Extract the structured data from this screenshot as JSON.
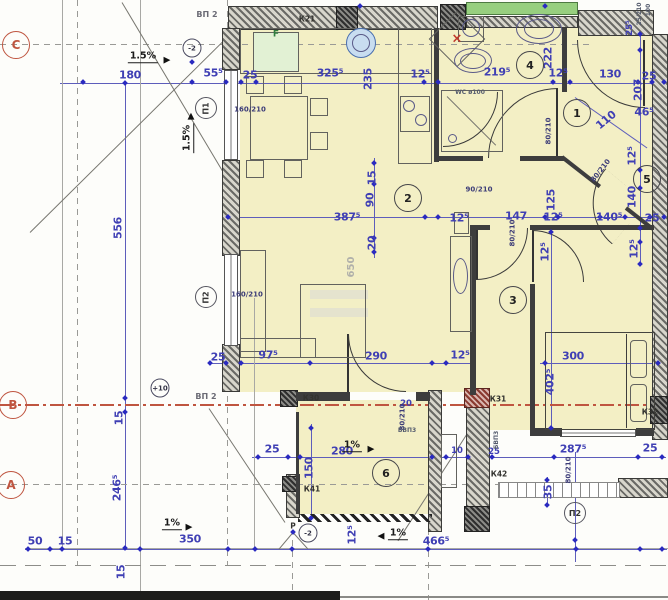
{
  "title": "Apartment floor plan sheet",
  "colors": {
    "blue": "#3f3fb4",
    "red": "#bf5540",
    "yellow": "#f3efc5",
    "green": "#97cf7f",
    "wall": "#3d3d3d"
  },
  "annotations": [
    {
      "t": "ВП 2",
      "x": 207,
      "y": 15,
      "c": "gray"
    },
    {
      "t": "1.5%",
      "x": 143,
      "y": 57,
      "c": "slope"
    },
    {
      "t": "▶",
      "x": 167,
      "y": 61,
      "c": "arrow"
    },
    {
      "t": "180",
      "x": 130,
      "y": 75,
      "c": "d"
    },
    {
      "t": "55⁵",
      "x": 213,
      "y": 73,
      "c": "d"
    },
    {
      "t": "25",
      "x": 250,
      "y": 75,
      "c": "d"
    },
    {
      "t": "325⁵",
      "x": 330,
      "y": 73,
      "c": "d"
    },
    {
      "t": "12⁵",
      "x": 420,
      "y": 74,
      "c": "d"
    },
    {
      "t": "219⁵",
      "x": 497,
      "y": 72,
      "c": "d"
    },
    {
      "t": "12⁵",
      "x": 558,
      "y": 73,
      "c": "d"
    },
    {
      "t": "130",
      "x": 610,
      "y": 74,
      "c": "d"
    },
    {
      "t": "25",
      "x": 649,
      "y": 76,
      "c": "d"
    },
    {
      "t": "К21",
      "x": 307,
      "y": 19,
      "c": "k"
    },
    {
      "t": "F",
      "x": 276,
      "y": 35,
      "c": "greent"
    },
    {
      "t": "235",
      "x": 368,
      "y": 79,
      "r": -90,
      "c": "d"
    },
    {
      "t": "222",
      "x": 548,
      "y": 58,
      "r": -90,
      "c": "d"
    },
    {
      "t": "100",
      "x": 649,
      "y": 10,
      "r": -90,
      "c": "tiny"
    },
    {
      "t": "25/210",
      "x": 640,
      "y": 14,
      "r": -90,
      "c": "tiny"
    },
    {
      "t": "25⁵",
      "x": 630,
      "y": 28,
      "r": -90,
      "c": "ds"
    },
    {
      "t": "207",
      "x": 638,
      "y": 90,
      "r": -90,
      "c": "d"
    },
    {
      "t": "46⁵",
      "x": 644,
      "y": 112,
      "c": "d"
    },
    {
      "t": "110",
      "x": 606,
      "y": 120,
      "r": -40,
      "c": "d"
    },
    {
      "t": "80/210",
      "x": 549,
      "y": 131,
      "r": -90,
      "c": "door"
    },
    {
      "t": "12⁵",
      "x": 632,
      "y": 156,
      "r": -90,
      "c": "d"
    },
    {
      "t": "80/210",
      "x": 601,
      "y": 171,
      "r": -52,
      "c": "door"
    },
    {
      "t": "140",
      "x": 632,
      "y": 197,
      "r": -90,
      "c": "d"
    },
    {
      "t": "140⁵",
      "x": 609,
      "y": 217,
      "c": "d"
    },
    {
      "t": "25",
      "x": 652,
      "y": 218,
      "c": "d"
    },
    {
      "t": "12⁵",
      "x": 634,
      "y": 249,
      "r": -90,
      "c": "d"
    },
    {
      "t": "1.5%",
      "x": 188,
      "y": 138,
      "r": -90,
      "c": "slope"
    },
    {
      "t": "▲",
      "x": 191,
      "y": 117,
      "c": "arrow"
    },
    {
      "t": "160/210",
      "x": 250,
      "y": 110,
      "c": "door"
    },
    {
      "t": "90/210",
      "x": 479,
      "y": 190,
      "c": "door"
    },
    {
      "t": "15",
      "x": 372,
      "y": 178,
      "r": -90,
      "c": "d"
    },
    {
      "t": "90",
      "x": 370,
      "y": 200,
      "r": -90,
      "c": "d"
    },
    {
      "t": "20",
      "x": 372,
      "y": 243,
      "r": -90,
      "c": "d"
    },
    {
      "t": "387⁵",
      "x": 347,
      "y": 217,
      "c": "d"
    },
    {
      "t": "147",
      "x": 516,
      "y": 216,
      "c": "d"
    },
    {
      "t": "12⁵",
      "x": 459,
      "y": 218,
      "c": "d"
    },
    {
      "t": "12⁵",
      "x": 553,
      "y": 217,
      "c": "d"
    },
    {
      "t": "125",
      "x": 551,
      "y": 200,
      "r": -90,
      "c": "d"
    },
    {
      "t": "80/210",
      "x": 513,
      "y": 233,
      "r": -90,
      "c": "door"
    },
    {
      "t": "12⁵",
      "x": 545,
      "y": 252,
      "r": -90,
      "c": "d"
    },
    {
      "t": "650",
      "x": 352,
      "y": 267,
      "r": -90,
      "c": "grayd"
    },
    {
      "t": "556",
      "x": 118,
      "y": 228,
      "r": -90,
      "c": "d"
    },
    {
      "t": "160/210",
      "x": 247,
      "y": 295,
      "c": "door"
    },
    {
      "t": "25",
      "x": 218,
      "y": 357,
      "c": "d"
    },
    {
      "t": "97⁵",
      "x": 268,
      "y": 355,
      "c": "d"
    },
    {
      "t": "290",
      "x": 376,
      "y": 356,
      "c": "d"
    },
    {
      "t": "12⁵",
      "x": 460,
      "y": 355,
      "c": "d"
    },
    {
      "t": "300",
      "x": 573,
      "y": 356,
      "c": "d"
    },
    {
      "t": "402⁵",
      "x": 550,
      "y": 382,
      "r": -90,
      "c": "d"
    },
    {
      "t": "WC ø100",
      "x": 470,
      "y": 93,
      "c": "tiny"
    },
    {
      "t": "ВП 2",
      "x": 206,
      "y": 397,
      "c": "gray"
    },
    {
      "t": "К30",
      "x": 311,
      "y": 398,
      "c": "k"
    },
    {
      "t": "К31",
      "x": 498,
      "y": 399,
      "c": "k"
    },
    {
      "t": "К32",
      "x": 650,
      "y": 412,
      "c": "k"
    },
    {
      "t": "15",
      "x": 119,
      "y": 418,
      "r": -90,
      "c": "d"
    },
    {
      "t": "246⁵",
      "x": 117,
      "y": 488,
      "r": -90,
      "c": "d"
    },
    {
      "t": "25",
      "x": 272,
      "y": 449,
      "c": "d"
    },
    {
      "t": "280",
      "x": 342,
      "y": 451,
      "c": "d"
    },
    {
      "t": "10",
      "x": 457,
      "y": 451,
      "c": "ds"
    },
    {
      "t": "25",
      "x": 494,
      "y": 452,
      "c": "ds"
    },
    {
      "t": "287⁵",
      "x": 573,
      "y": 449,
      "c": "d"
    },
    {
      "t": "25",
      "x": 650,
      "y": 448,
      "c": "d"
    },
    {
      "t": "20",
      "x": 406,
      "y": 404,
      "c": "ds"
    },
    {
      "t": "80/210",
      "x": 403,
      "y": 417,
      "r": -90,
      "c": "door"
    },
    {
      "t": "БВП3",
      "x": 407,
      "y": 431,
      "c": "tiny"
    },
    {
      "t": "БВП3",
      "x": 497,
      "y": 440,
      "r": -90,
      "c": "tiny"
    },
    {
      "t": "К41",
      "x": 312,
      "y": 489,
      "c": "k"
    },
    {
      "t": "К42",
      "x": 499,
      "y": 474,
      "c": "k"
    },
    {
      "t": "1%",
      "x": 352,
      "y": 446,
      "c": "slope"
    },
    {
      "t": "▶",
      "x": 371,
      "y": 450,
      "c": "arrow"
    },
    {
      "t": "150",
      "x": 309,
      "y": 468,
      "r": -90,
      "c": "d"
    },
    {
      "t": "80/210",
      "x": 569,
      "y": 470,
      "r": -90,
      "c": "door"
    },
    {
      "t": "35",
      "x": 548,
      "y": 492,
      "r": -90,
      "c": "d"
    },
    {
      "t": "Р",
      "x": 293,
      "y": 526,
      "c": "k"
    },
    {
      "t": "50",
      "x": 35,
      "y": 541,
      "c": "d"
    },
    {
      "t": "15",
      "x": 65,
      "y": 541,
      "c": "d"
    },
    {
      "t": "1%",
      "x": 172,
      "y": 524,
      "c": "slope"
    },
    {
      "t": "▶",
      "x": 189,
      "y": 528,
      "c": "arrow"
    },
    {
      "t": "350",
      "x": 190,
      "y": 539,
      "c": "d"
    },
    {
      "t": "15",
      "x": 121,
      "y": 572,
      "r": -90,
      "c": "d"
    },
    {
      "t": "12⁵",
      "x": 352,
      "y": 535,
      "r": -90,
      "c": "d"
    },
    {
      "t": "◀",
      "x": 381,
      "y": 537,
      "c": "arrow"
    },
    {
      "t": "1%",
      "x": 398,
      "y": 534,
      "c": "slope"
    },
    {
      "t": "466⁵",
      "x": 436,
      "y": 541,
      "c": "d"
    },
    {
      "t": "×",
      "x": 457,
      "y": 39,
      "c": "redx"
    }
  ],
  "room_circles": [
    {
      "t": "1",
      "x": 577,
      "y": 113
    },
    {
      "t": "2",
      "x": 408,
      "y": 198
    },
    {
      "t": "3",
      "x": 513,
      "y": 300
    },
    {
      "t": "4",
      "x": 530,
      "y": 65
    },
    {
      "t": "5",
      "x": 647,
      "y": 179
    },
    {
      "t": "6",
      "x": 386,
      "y": 473
    }
  ],
  "grid_circles": [
    {
      "t": "C",
      "x": 16,
      "y": 45
    },
    {
      "t": "B",
      "x": 13,
      "y": 405
    },
    {
      "t": "A",
      "x": 11,
      "y": 485
    }
  ],
  "marker_circles": [
    {
      "t": "-2",
      "x": 192,
      "y": 48
    },
    {
      "t": "-2",
      "x": 308,
      "y": 533
    },
    {
      "t": "+10",
      "x": 160,
      "y": 388
    }
  ],
  "panel_circles": [
    {
      "t": "П1",
      "x": 206,
      "y": 108,
      "r": -90
    },
    {
      "t": "П2",
      "x": 206,
      "y": 297,
      "r": -90
    },
    {
      "t": "П2",
      "x": 575,
      "y": 513
    }
  ]
}
